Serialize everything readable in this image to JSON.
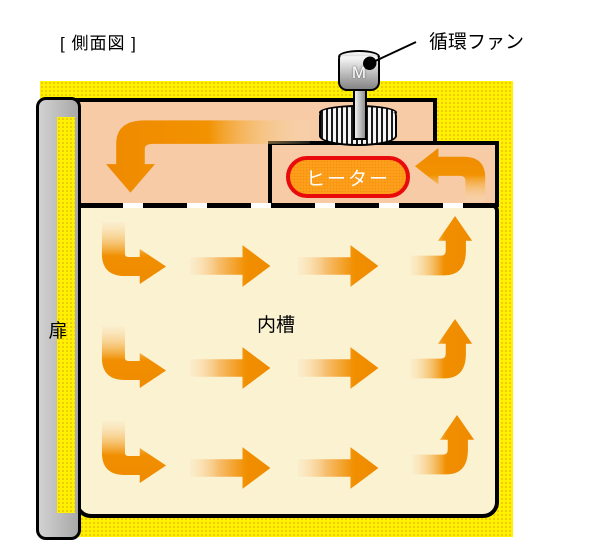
{
  "title": "[ 側面図 ]",
  "labels": {
    "fan": "循環ファン",
    "motor": "M",
    "heater": "ヒーター",
    "inner_chamber": "内槽",
    "door": "扉"
  },
  "icons": {
    "fan_motor": "motor-cylinder",
    "fan_rotor": "striped-cylinder-fan",
    "plenum_flow": "arrow-bend-down-left",
    "heater_flow": "arrow-hook-left",
    "row_flow_left": "arrow-bend-down-right",
    "row_flow_straight": "arrow-right",
    "row_flow_up": "arrow-bend-up"
  },
  "colors": {
    "body_yellow": "#FFF100",
    "plenum_pink": "#F6CBA6",
    "chamber_cream": "#FBF2D2",
    "arrow_orange": "#F18F00",
    "arrow_fade": "#FAE3BC",
    "heater_fill": "#FFA41E",
    "heater_border": "#E90B0B",
    "door_gray": "#B5B5B5"
  }
}
